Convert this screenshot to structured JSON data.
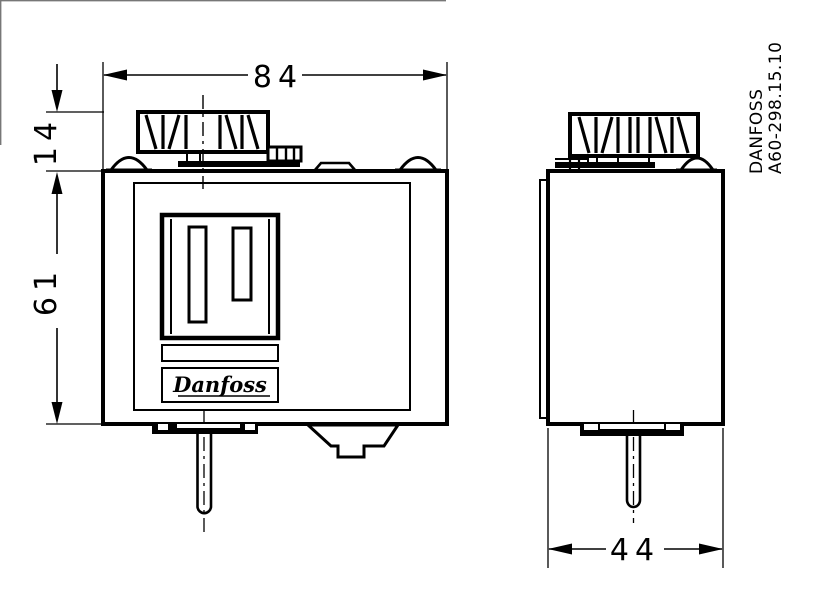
{
  "page": {
    "background": "#ffffff",
    "line_color": "#000000"
  },
  "drawing": {
    "type": "technical-dimension-drawing",
    "dimensions": {
      "overall_width_mm": "84",
      "knob_height_mm": "14",
      "body_height_mm": "61",
      "depth_mm": "44"
    },
    "title_block": {
      "brand": "DANFOSS",
      "drawing_number": "A60-298.15.10"
    },
    "front_view": {
      "logo_text": "Danfoss"
    }
  }
}
